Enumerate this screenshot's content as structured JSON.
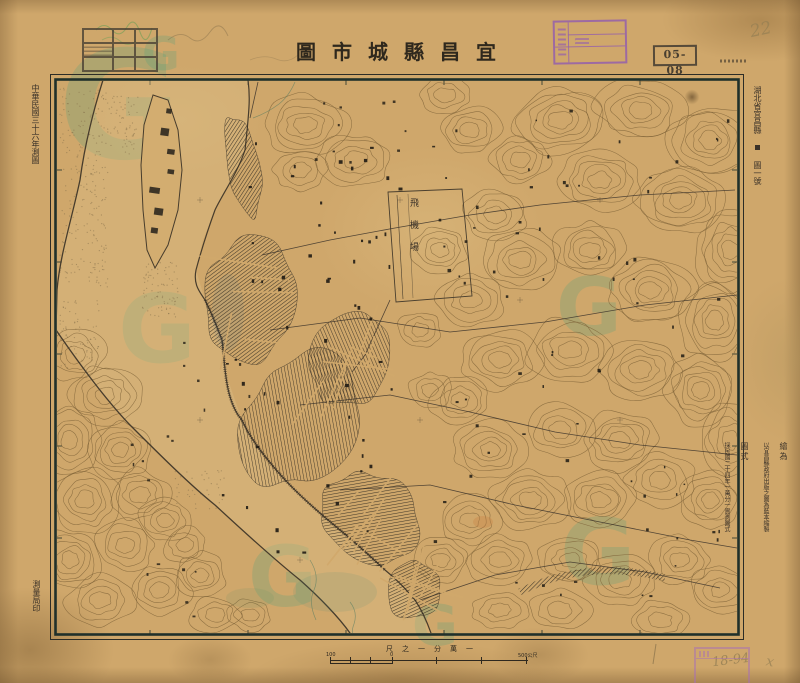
{
  "document": {
    "title_rtl": "圖市城縣昌宜",
    "title": "宜昌縣城市圖",
    "catalog_number": "05-08",
    "survey_note_left": "中華民國三十六年測圖",
    "printer_note_left": "測量局印",
    "sheet_label_region": "湖北省宜昌縣",
    "sheet_label_number": "圖一號",
    "notes": [
      {
        "head": "繪為",
        "body": "以宜昌縣政府出版之圖為藍本縮製"
      },
      {
        "head": "圖式",
        "body": "採民國二十四年一萬分一實測圖式"
      }
    ],
    "pencil_marks": {
      "top_right": "22",
      "bottom_right": "18-94",
      "cross": "x"
    }
  },
  "scale_bar": {
    "caption": "尺之一分萬一",
    "left_label": "100",
    "zero_label": "0",
    "right_label": "500公尺"
  },
  "map": {
    "airfield_label": "飛機場"
  },
  "watermark": {
    "letter": "G"
  },
  "colors": {
    "paper": "#cfa76b",
    "ink": "#2e281f",
    "contour": "#7d6137",
    "stamp_purple": "#9a63b0",
    "watermark_green": "#34a082"
  }
}
